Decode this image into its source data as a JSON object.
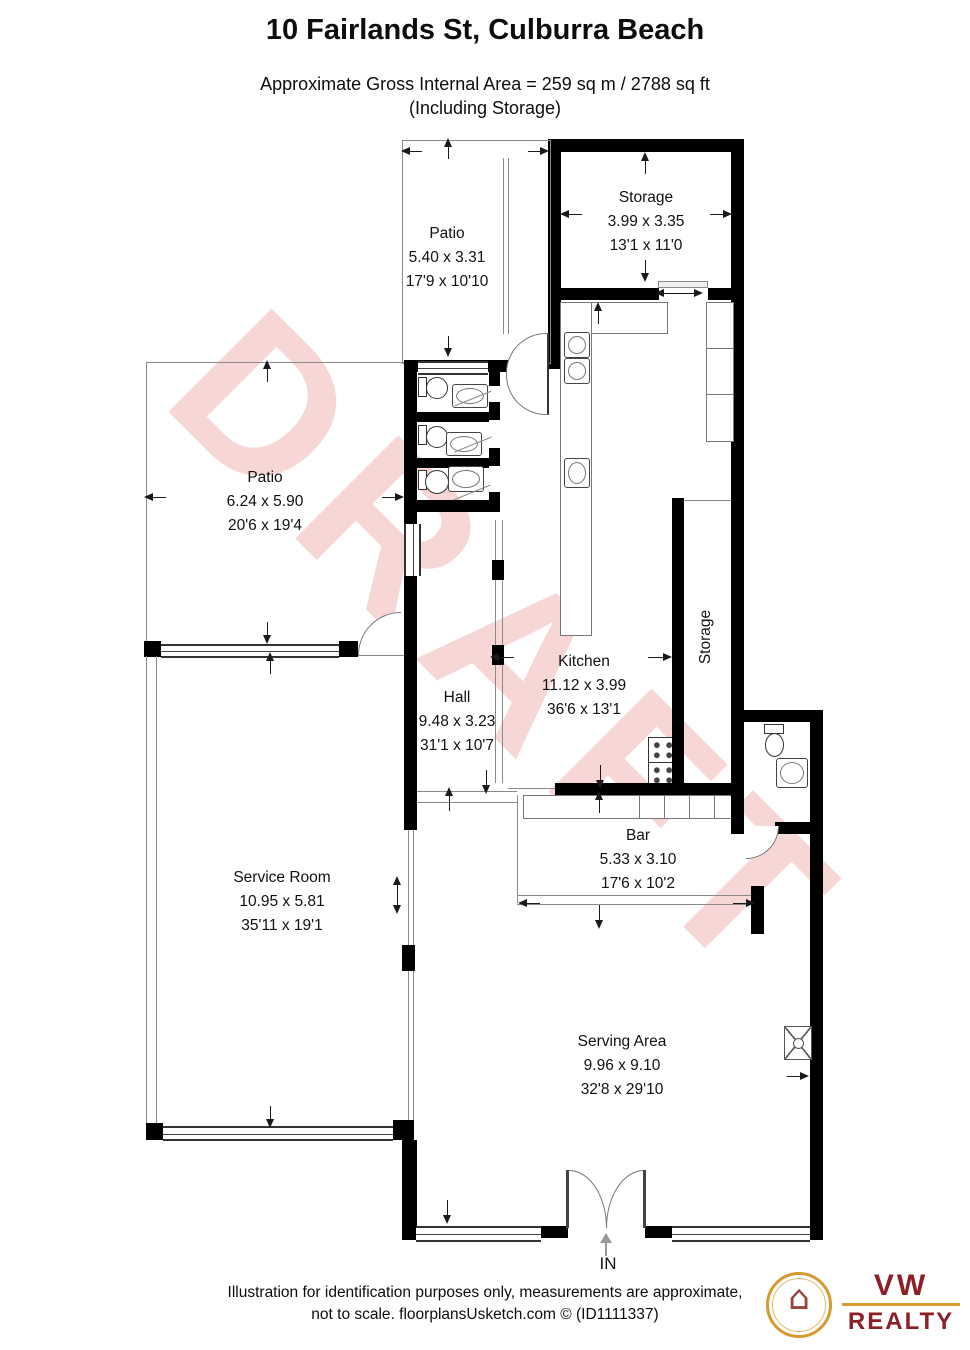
{
  "header": {
    "title": "10 Fairlands St, Culburra Beach",
    "subtitle_line1": "Approximate Gross Internal Area = 259 sq m / 2788 sq ft",
    "subtitle_line2": "(Including Storage)"
  },
  "watermark": "DRAFT",
  "rooms": {
    "storage_top": {
      "name": "Storage",
      "metric": "3.99 x 3.35",
      "imperial": "13'1 x 11'0"
    },
    "patio_top": {
      "name": "Patio",
      "metric": "5.40 x 3.31",
      "imperial": "17'9 x 10'10"
    },
    "patio_left": {
      "name": "Patio",
      "metric": "6.24 x 5.90",
      "imperial": "20'6 x 19'4"
    },
    "kitchen": {
      "name": "Kitchen",
      "metric": "11.12 x 3.99",
      "imperial": "36'6 x 13'1"
    },
    "hall": {
      "name": "Hall",
      "metric": "9.48 x 3.23",
      "imperial": "31'1 x 10'7"
    },
    "bar": {
      "name": "Bar",
      "metric": "5.33 x 3.10",
      "imperial": "17'6 x 10'2"
    },
    "service_room": {
      "name": "Service Room",
      "metric": "10.95 x 5.81",
      "imperial": "35'11 x 19'1"
    },
    "serving_area": {
      "name": "Serving Area",
      "metric": "9.96 x 9.10",
      "imperial": "32'8 x 29'10"
    },
    "storage_corridor": {
      "name": "Storage"
    }
  },
  "entrance": {
    "label": "IN"
  },
  "footer": {
    "line1": "Illustration for identification purposes only, measurements are approximate,",
    "line2": "not to scale. floorplansUsketch.com © (ID1111337)"
  },
  "logo": {
    "name_top": "VW",
    "name_bottom": "REALTY",
    "crest_glyph": "⌂"
  },
  "colors": {
    "wall": "#000000",
    "thin_wall": "#8a8a8a",
    "watermark": "#f7d6d6",
    "logo_gold": "#d79a2f",
    "logo_red": "#8c2026"
  }
}
